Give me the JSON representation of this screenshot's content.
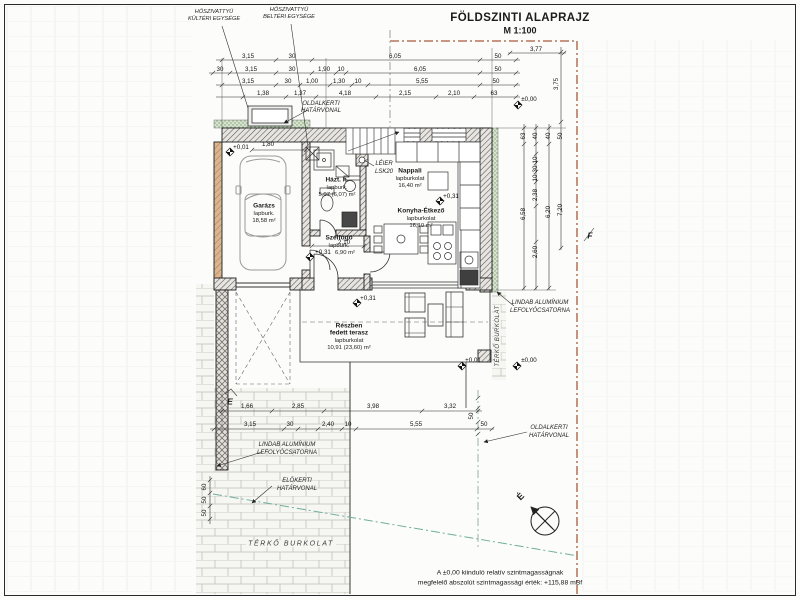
{
  "title": {
    "main": "FÖLDSZINTI ALAPRAJZ",
    "scale": "M 1:100"
  },
  "labels": {
    "heatpump_outdoor_l1": "HŐSZIVATTYÚ",
    "heatpump_outdoor_l2": "KÜLTÉRI EGYSÉGE",
    "heatpump_indoor_l1": "HŐSZIVATTYÚ",
    "heatpump_indoor_l2": "BELTÉRI EGYSÉGE",
    "side_boundary_l1": "OLDALKERTI",
    "side_boundary_l2": "HATÁRVONAL",
    "gutter_l1": "LINDAB ALUMÍNIUM",
    "gutter_l2": "LEFOLYÓCSATORNA",
    "front_boundary_l1": "ELŐKERTI",
    "front_boundary_l2": "HATÁRVONAL",
    "paving": "TÉRKŐ BURKOLAT",
    "chimney_l1": "LÉIER",
    "chimney_l2": "LSK20"
  },
  "rooms": {
    "garage": {
      "name": "Garázs",
      "finish": "lapburk.",
      "area": "18,58 m²"
    },
    "utility": {
      "name": "Házt. h.",
      "finish": "lapburk.",
      "area": "5,07 (6,07) m²"
    },
    "living": {
      "name": "Nappali",
      "finish": "lapburkolat",
      "area": "16,40 m²"
    },
    "kitchen": {
      "name": "Konyha-Étkező",
      "finish": "lapburkolat",
      "area": "16,10 m²"
    },
    "vestibule": {
      "name": "Szélfogó",
      "finish": "lapburk.",
      "area": "6,90 m²"
    },
    "terrace": {
      "name_l1": "Részben",
      "name_l2": "fedett terasz",
      "finish": "lapburkolat",
      "area": "10,91 (23,60) m²"
    }
  },
  "elevations": {
    "garage": "+0,01",
    "vestibule": "+0,31",
    "living": "+0,31",
    "terrace": "+0,31",
    "terrace_edge": "+0,01",
    "ne": "±0,00",
    "se": "±0,00"
  },
  "dims": {
    "top1": [
      "3,15",
      "30",
      "6,05",
      "50"
    ],
    "top2": [
      "30",
      "3,15",
      "30",
      "1,90",
      "10",
      "6,05",
      "50"
    ],
    "top3": [
      "3,15",
      "30",
      "1,00",
      "1,30",
      "10",
      "5,55",
      "50"
    ],
    "top4": [
      "1,38",
      "1,37",
      "4,18",
      "2,15",
      "2,10",
      "63"
    ],
    "top_right": "3,77",
    "right_v": [
      "3,75",
      "63",
      "40",
      "40",
      "50",
      "10",
      "30",
      "10",
      "2,38",
      "6,58",
      "6,20",
      "7,20",
      "2,60",
      "50"
    ],
    "garage_door": "1,80",
    "vestibule_w": "2,10",
    "left_v": [
      "60",
      "50",
      "50"
    ],
    "bottom1": [
      "1,66",
      "2,85",
      "3,98",
      "3,32"
    ],
    "bottom2": [
      "3,15",
      "30",
      "2,40",
      "10",
      "5,55",
      "50"
    ]
  },
  "markers": {
    "section_e": "E",
    "section_f": "F",
    "north": "É"
  },
  "note": {
    "l1": "A ±0,00 kiinduló relatív szintmagasságnak",
    "l2": "megfelelő abszolút szintmagassági érték: +115,88 mBf"
  },
  "colors": {
    "boundary": "#a85a3c",
    "front_boundary": "#6fae9e",
    "insulation": "#d7e3cf",
    "wall_tan": "#d9b690"
  }
}
